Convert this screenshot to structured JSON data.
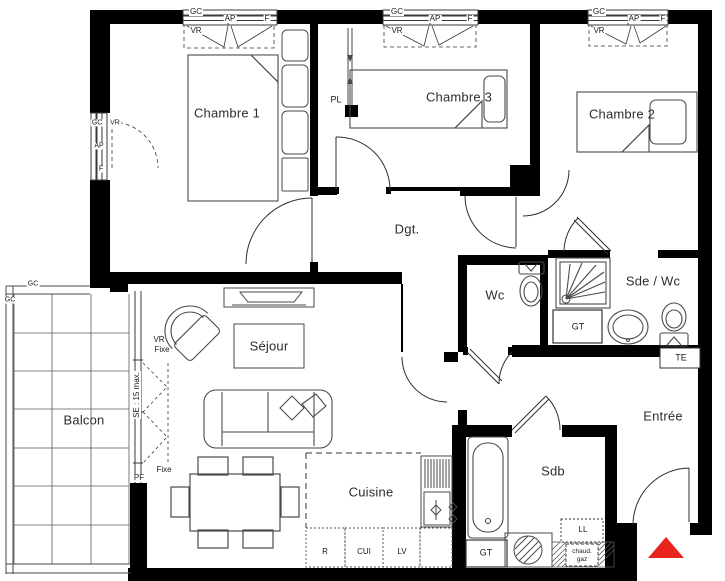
{
  "plan": {
    "rooms": {
      "chambre1": "Chambre 1",
      "chambre3": "Chambre 3",
      "chambre2": "Chambre 2",
      "degagement": "Dgt.",
      "wc": "Wc",
      "sde_wc": "Sde / Wc",
      "sejour": "Séjour",
      "balcon": "Balcon",
      "cuisine": "Cuisine",
      "sdb": "Sdb",
      "entree": "Entrée"
    },
    "window_labels": {
      "gc": "GC",
      "ap": "AP",
      "f": "F",
      "vr": "VR",
      "fixe": "Fixe",
      "pf": "PF",
      "se_max": "SE : 15 max."
    },
    "equipment_labels": {
      "pl": "PL",
      "gt": "GT",
      "te": "TE",
      "ll": "LL",
      "chaud": "chaud.",
      "gaz": "gaz",
      "r": "R",
      "cui": "CUI",
      "lv": "LV"
    },
    "colors": {
      "wall": "#000000",
      "line": "#4a4a4a",
      "entrance_marker": "#e8251c",
      "background": "#ffffff"
    }
  }
}
